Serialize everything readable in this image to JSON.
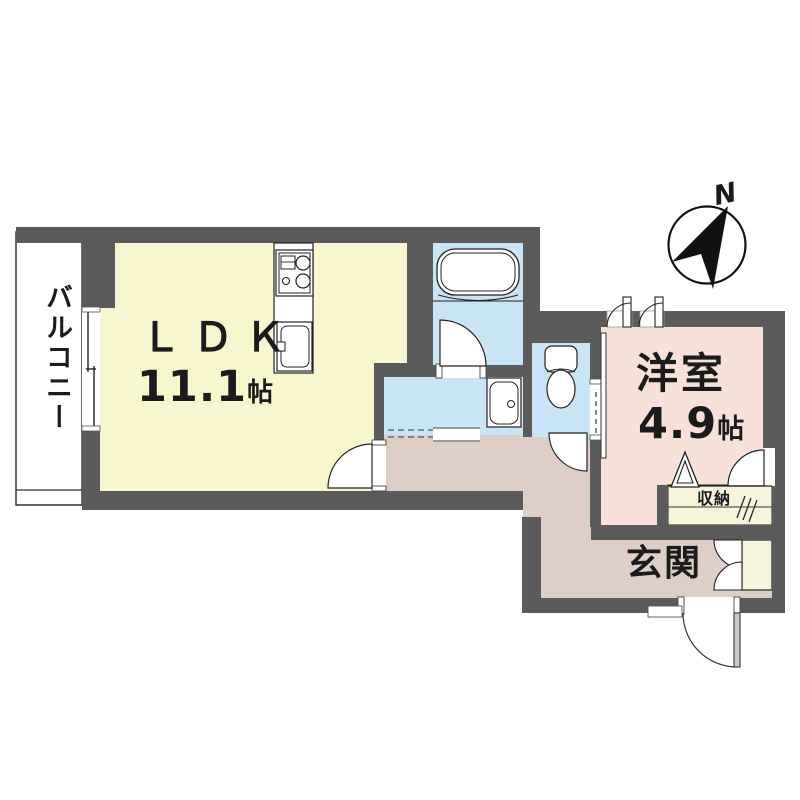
{
  "compass": {
    "north_label": "N"
  },
  "rooms": {
    "balcony": {
      "label": "バルコニー"
    },
    "ldk": {
      "label": "ＬＤＫ",
      "size_value": "11.1",
      "size_unit": "帖"
    },
    "western_room": {
      "label": "洋室",
      "size_value": "4.9",
      "size_unit": "帖"
    },
    "entrance": {
      "label": "玄関"
    },
    "storage": {
      "label": "収納"
    }
  },
  "colors": {
    "wall": "#5B5B5B",
    "room_ldk": "#F8F6CF",
    "room_wet": "#C9E4F4",
    "room_western": "#F8E1D8",
    "room_hall": "#DFCDC7",
    "room_storage": "#F7F4DC",
    "outline": "#222222"
  }
}
